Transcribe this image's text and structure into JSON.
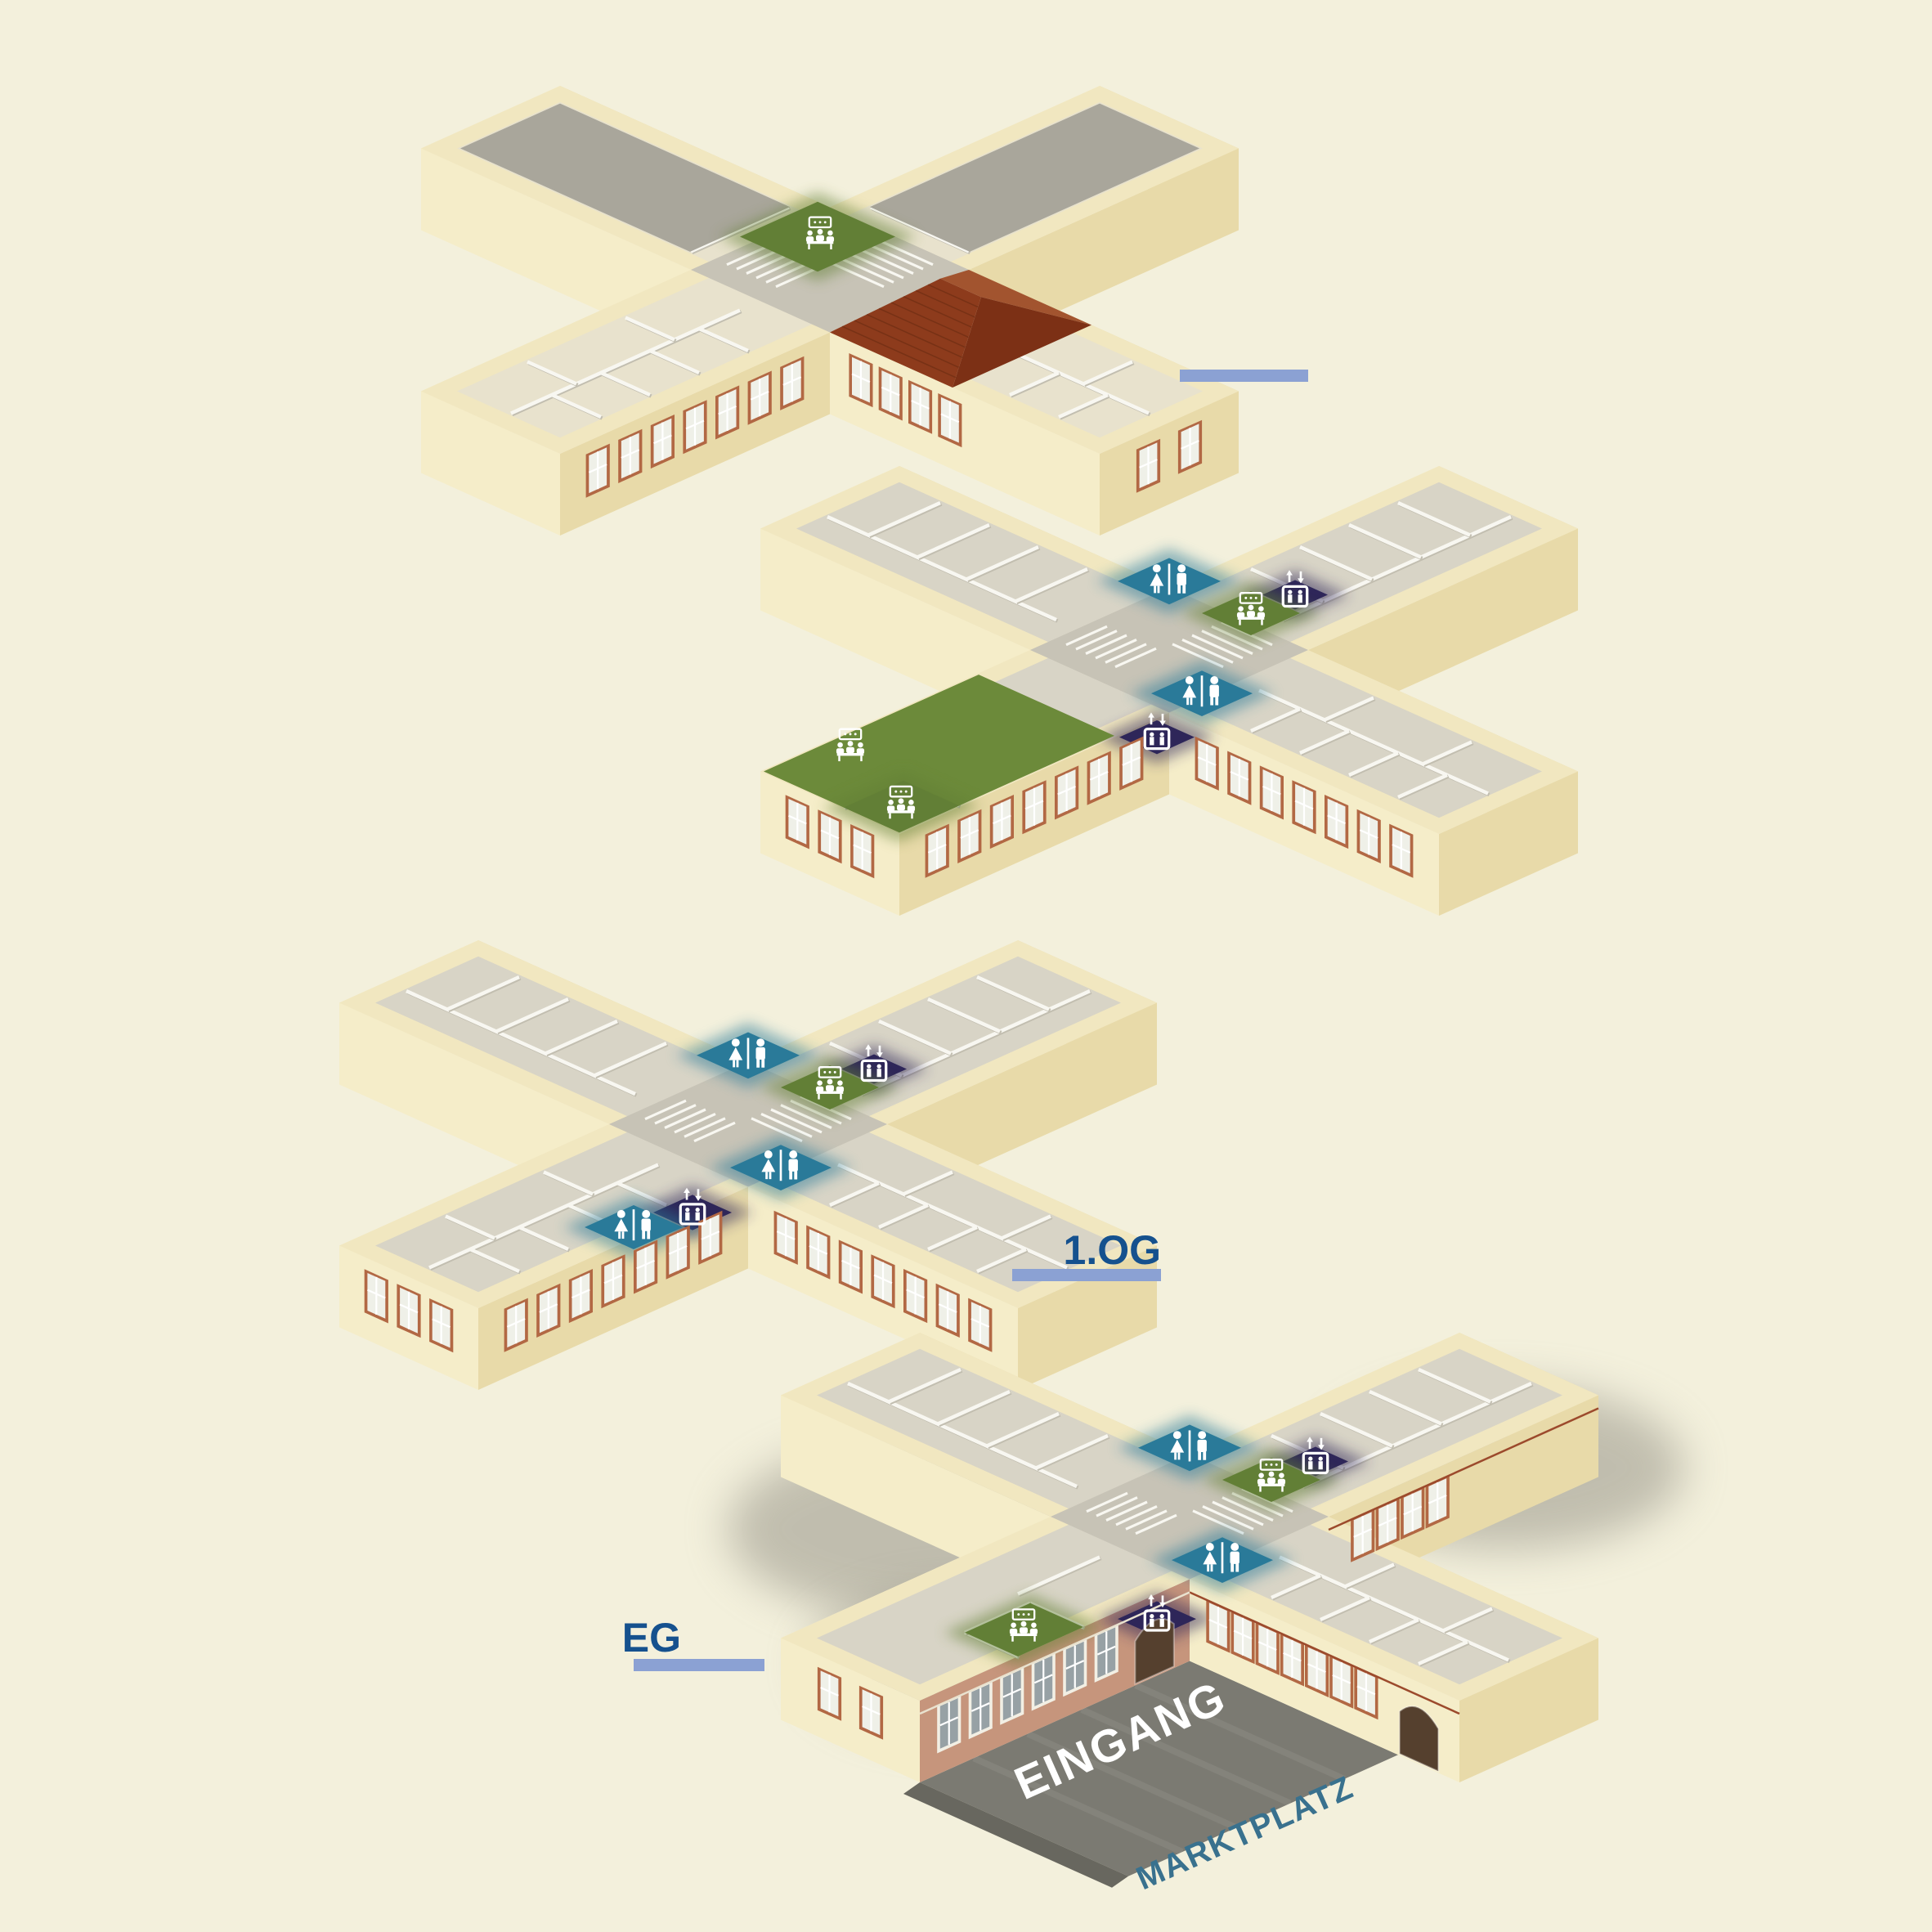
{
  "background": "#f3f0dc",
  "colors": {
    "wall_top": "#f1e7c0",
    "wall_light": "#f5edc9",
    "wall_dark": "#e8daa9",
    "floor": "#d8d4c6",
    "floor_attic": "#e8e2cd",
    "terrace": "#a9a69b",
    "stair": "#c7c3b6",
    "partition": "#f8f7f1",
    "partition_shadow": "#c2beb0",
    "wc": "#2a7a99",
    "elevator": "#2e2659",
    "meeting": "#627f36",
    "meeting_hall": "#6c8a3a",
    "roof_front": "#8d3b1c",
    "roof_back": "#a2542f",
    "roof_right": "#7c3015",
    "facade_pink": "#c6957c",
    "window_frame": "#b26844",
    "window_frame_eg": "#f2efe4",
    "window_glass": "#eff0e8",
    "window_glass_eg": "#97a1a5",
    "arch_door": "#55402e",
    "marker_bar": "#8ba1d3",
    "label_blue": "#15518e",
    "street": "#7b7a72",
    "street_label": "#39718e",
    "entrance_label": "#ffffff",
    "ground_shadow": "#8f8c81",
    "icon": "#ffffff"
  },
  "labels": {
    "floor_1og": "1.OG",
    "floor_eg": "EG",
    "entrance": "EINGANG",
    "square": "MARKTPLATZ"
  },
  "icon_types": {
    "wc": "wc-icon",
    "elevator": "elevator-icon",
    "meeting-room": "meeting-room-icon"
  },
  "floors": [
    {
      "id": "dach",
      "name": "top floor with roof and terraces",
      "label": "",
      "marker_bar": true,
      "roof": true,
      "icons": [
        {
          "type": "meeting-room",
          "u": -50,
          "v": -38
        }
      ],
      "zones": [
        {
          "kind": "terrace",
          "rect": [
            -391,
            -61,
            -110,
            61
          ]
        },
        {
          "kind": "terrace",
          "rect": [
            -61,
            -391,
            61,
            -110
          ]
        },
        {
          "kind": "meeting-room",
          "rect": [
            -100,
            -85,
            -5,
            10
          ]
        }
      ]
    },
    {
      "id": "2og",
      "name": "second upper floor with council hall",
      "label": "",
      "icons": [
        {
          "type": "wc",
          "u": -93,
          "v": -93
        },
        {
          "type": "elevator",
          "u": 2,
          "v": -152
        },
        {
          "type": "meeting-room",
          "u": 0,
          "v": -100
        },
        {
          "type": "wc",
          "u": 79,
          "v": 39
        },
        {
          "type": "elevator",
          "u": 111,
          "v": 126
        },
        {
          "type": "meeting-room",
          "u": -60,
          "v": 330
        },
        {
          "type": "meeting-room",
          "u": 49,
          "v": 377
        }
      ],
      "zones": [
        {
          "kind": "wc",
          "rect": [
            -125,
            -125,
            -62,
            -62
          ]
        },
        {
          "kind": "elevator",
          "rect": [
            -18,
            -172,
            22,
            -132
          ]
        },
        {
          "kind": "meeting-room",
          "rect": [
            -30,
            -130,
            30,
            -70
          ]
        },
        {
          "kind": "wc",
          "rect": [
            48,
            8,
            110,
            70
          ]
        },
        {
          "kind": "elevator",
          "rect": [
            88,
            103,
            134,
            149
          ]
        },
        {
          "kind": "meeting-hall",
          "rect": [
            -83,
            150,
            83,
            413
          ]
        },
        {
          "kind": "meeting-room",
          "rect": [
            15,
            340,
            83,
            413
          ]
        }
      ]
    },
    {
      "id": "1og",
      "name": "first upper floor",
      "label": "1.OG",
      "marker_bar": true,
      "icons": [
        {
          "type": "wc",
          "u": -93,
          "v": -93
        },
        {
          "type": "elevator",
          "u": 2,
          "v": -152
        },
        {
          "type": "meeting-room",
          "u": 0,
          "v": -100
        },
        {
          "type": "wc",
          "u": 79,
          "v": 39
        },
        {
          "type": "elevator",
          "u": 86,
          "v": 154
        },
        {
          "type": "wc",
          "u": 70,
          "v": 210
        }
      ],
      "zones": [
        {
          "kind": "wc",
          "rect": [
            -125,
            -125,
            -62,
            -62
          ]
        },
        {
          "kind": "elevator",
          "rect": [
            -18,
            -172,
            22,
            -132
          ]
        },
        {
          "kind": "meeting-room",
          "rect": [
            -30,
            -130,
            30,
            -70
          ]
        },
        {
          "kind": "wc",
          "rect": [
            48,
            8,
            110,
            70
          ]
        },
        {
          "kind": "elevator",
          "rect": [
            62,
            130,
            110,
            178
          ]
        },
        {
          "kind": "wc",
          "rect": [
            40,
            180,
            100,
            240
          ]
        }
      ]
    },
    {
      "id": "eg",
      "name": "ground floor with entrance and market square",
      "label": "EG",
      "marker_bar": true,
      "street": true,
      "icons": [
        {
          "type": "wc",
          "u": -93,
          "v": -93
        },
        {
          "type": "elevator",
          "u": 2,
          "v": -152
        },
        {
          "type": "meeting-room",
          "u": 0,
          "v": -100
        },
        {
          "type": "wc",
          "u": 79,
          "v": 39
        },
        {
          "type": "elevator",
          "u": 119,
          "v": 159
        },
        {
          "type": "meeting-room",
          "u": 52,
          "v": 255
        }
      ],
      "zones": [
        {
          "kind": "wc",
          "rect": [
            -125,
            -125,
            -62,
            -62
          ]
        },
        {
          "kind": "elevator",
          "rect": [
            -18,
            -172,
            22,
            -132
          ]
        },
        {
          "kind": "meeting-room",
          "rect": [
            -30,
            -130,
            30,
            -70
          ]
        },
        {
          "kind": "wc",
          "rect": [
            48,
            8,
            110,
            70
          ]
        },
        {
          "kind": "elevator",
          "rect": [
            95,
            135,
            143,
            183
          ]
        },
        {
          "kind": "meeting-room",
          "rect": [
            20,
            215,
            85,
            295
          ]
        }
      ]
    }
  ]
}
